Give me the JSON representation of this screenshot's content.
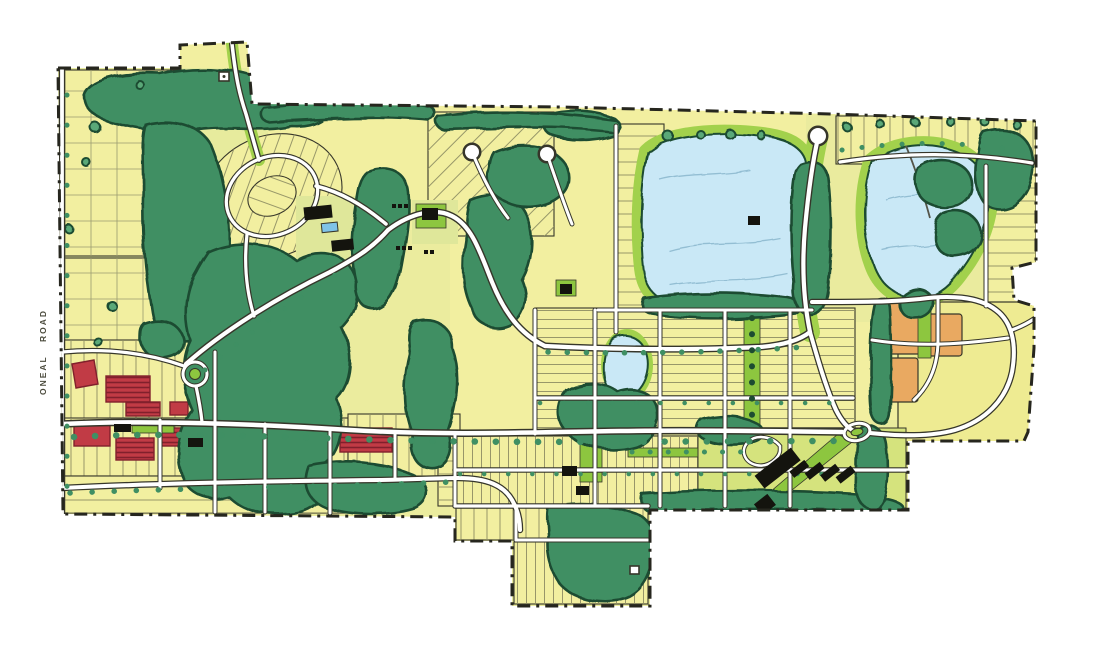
{
  "map": {
    "type": "hand-drawn community master plan",
    "road_label": "ONEAL ROAD"
  },
  "colors": {
    "lotYellow": "#f2efa0",
    "lotPale": "#f7f4b8",
    "washGreen": "#dfe79a",
    "openParcel": "#eeeb92",
    "schoolLawn": "#d5e37d",
    "canopy": "#3f8f63",
    "canopyDark": "#1d4c31",
    "canopyLight": "#5aa878",
    "lawn": "#a2d14c",
    "lawnBright": "#8dc63f",
    "lake": "#c9e8f6",
    "lakeEdge": "#93bed3",
    "red": "#c13b45",
    "redDark": "#81202c",
    "orange": "#e9a961",
    "road": "#ffffff",
    "casing": "#36362a",
    "building": "#14140e",
    "boundary": "#26261e",
    "labelInk": "#4a4a3c",
    "pool": "#7fc3e8"
  }
}
